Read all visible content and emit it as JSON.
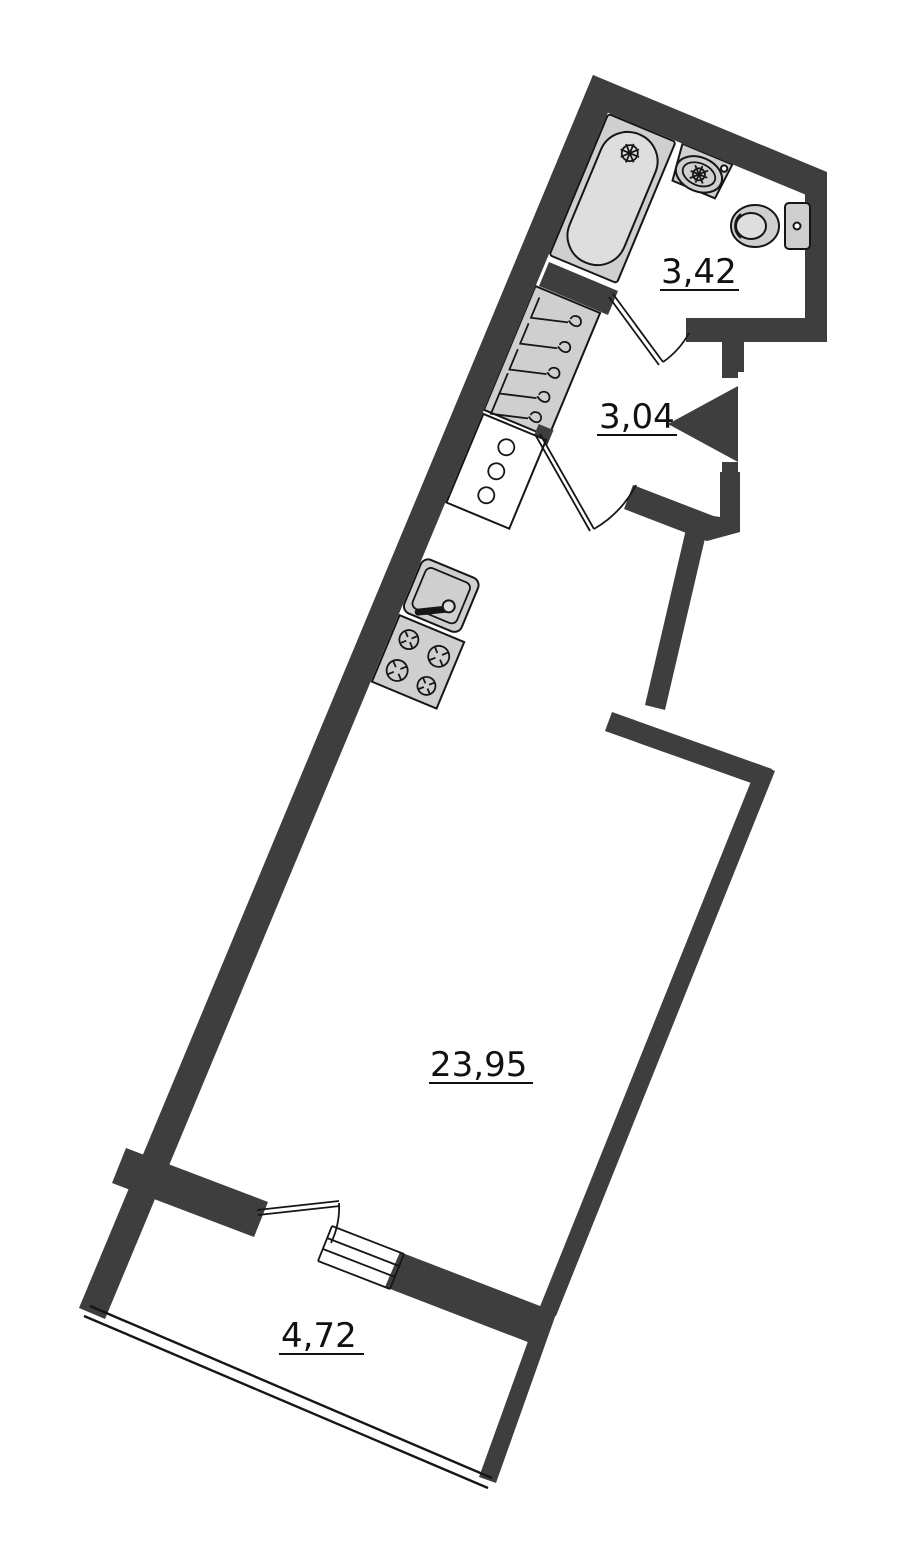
{
  "plan": {
    "type": "apartment-floor-plan",
    "rooms": {
      "bathroom": {
        "area_label": "3,42"
      },
      "hallway": {
        "area_label": "3,04"
      },
      "living_room": {
        "area_label": "23,95"
      },
      "balcony": {
        "area_label": "4,72"
      }
    },
    "icons": [
      "bathtub-icon",
      "wash-basin-icon",
      "toilet-icon",
      "wardrobe-hangers-icon",
      "kitchen-counter-icon",
      "kitchen-sink-icon",
      "stove-icon",
      "entrance-door-triangle-icon",
      "door-swing-arc-icon",
      "balcony-glazing-icon",
      "window-icon"
    ],
    "colors": {
      "wall": "#3e3e3e",
      "fixture_fill": "#cfcfcf",
      "fixture_fill_light": "#dedede",
      "outline": "#161616",
      "background": "#ffffff"
    }
  }
}
